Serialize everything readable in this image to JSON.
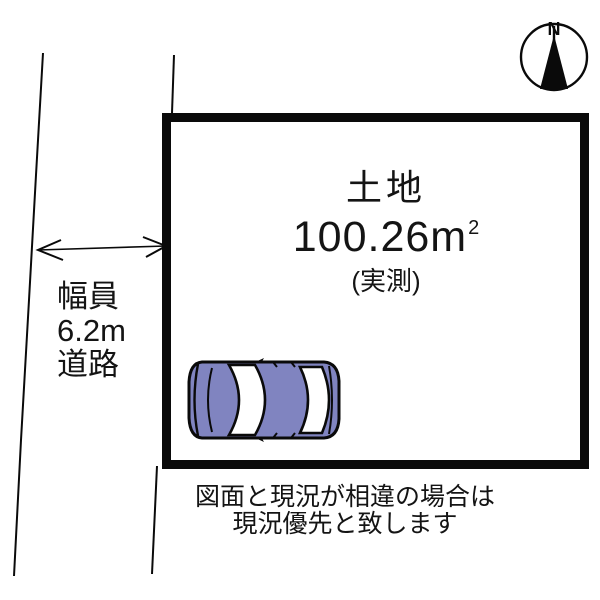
{
  "canvas": {
    "background": "#ffffff",
    "ink_color": "#0a0a0a"
  },
  "compass": {
    "north_label": "N"
  },
  "land": {
    "label": "土地",
    "area_value": "100.26",
    "area_unit": "m",
    "area_exponent": "2",
    "measurement_note": "(実測)"
  },
  "road": {
    "width_label_line1": "幅員",
    "width_label_line2": "6.2m",
    "width_label_line3": "道路"
  },
  "disclaimer": {
    "line1": "図面と現況が相違の場合は",
    "line2": "現況優先と致します"
  },
  "car": {
    "body_color": "#8084c0",
    "window_color": "#ffffff"
  }
}
